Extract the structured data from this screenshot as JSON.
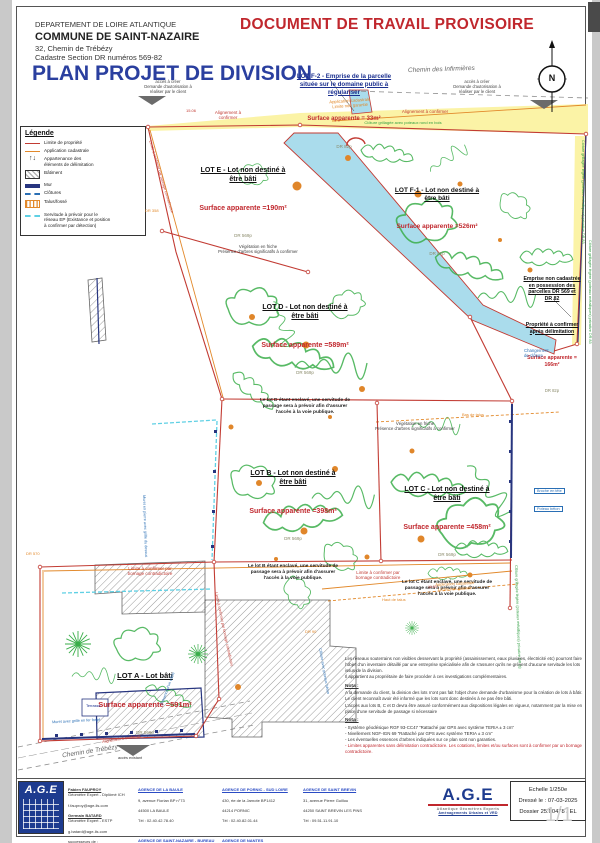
{
  "colors": {
    "title_blue": "#2a3f9f",
    "warning_red": "#c0272d",
    "boundary_red": "#c23b33",
    "cadastral_orange": "#e2892b",
    "vegetation_green": "#3aae4a",
    "water_blue": "#aadcec",
    "road_yellow": "#fbf3a6",
    "wall_blue": "#27357f",
    "servitude_cyan": "#5fd0e4"
  },
  "header": {
    "dept": "DEPARTEMENT DE LOIRE ATLANTIQUE",
    "commune": "COMMUNE DE SAINT-NAZAIRE",
    "address": "32, Chemin de Trébézy",
    "cadastre": "Cadastre Section DR numéros 569-82",
    "title": "PLAN PROJET DE DIVISION",
    "watermark": "DOCUMENT DE TRAVAIL PROVISOIRE"
  },
  "compass": "N",
  "legend": {
    "title": "Légende",
    "items": [
      {
        "label": "Limite de propriété"
      },
      {
        "label": "Application cadastrale"
      },
      {
        "label": "Appartenance des\néléments de délimitation"
      },
      {
        "label": "Bâtiment"
      },
      {
        "label": "Mur"
      },
      {
        "label": "Clôtures"
      },
      {
        "label": "Talus/fossé"
      },
      {
        "label": "Servitude à prévoir pour le\nréseau EP (Existance et position\nà confirmer par détection)"
      }
    ]
  },
  "lots": {
    "f2": {
      "title": "LOT F-2 - Emprise de la parcelle\nsituée sur le domaine public à\nrégulariser",
      "surface": "Surface apparente = 33m²",
      "parcel": "DR 82p"
    },
    "e": {
      "title": "LOT E - Lot non destiné à\nêtre bâti",
      "surface": "Surface apparente =190m²",
      "parcel": "DR 569p"
    },
    "f1": {
      "title": "LOT F-1 - Lot non destiné à\nêtre bâti",
      "surface": "Surface apparente =526m²",
      "parcel": "DR 82p"
    },
    "d": {
      "title": "LOT D - Lot non destiné à\nêtre bâti",
      "surface": "Surface apparente =589m²",
      "parcel": "DR 569p",
      "note": "Le lot D étant enclavé, une servitude de\npassage sera à prévoir afin d'assurer\nl'accès à la voie publique."
    },
    "b": {
      "title": "LOT B - Lot non destiné à\nêtre bâti",
      "surface": "Surface apparente =398m²",
      "parcel": "DR 569p",
      "note": "Le lot B étant enclavé, une servitude de\npassage sera à prévoir afin d'assurer\nl'accès à la voie publique."
    },
    "c": {
      "title": "LOT C - Lot non destiné à\nêtre bâti",
      "surface": "Surface apparente =458m²",
      "parcel": "DR 569p",
      "note": "Le lot C étant enclavé, une servitude de\npassage sera à prévoir afin d'assurer\nl'accès à la voie publique."
    },
    "a": {
      "title": "LOT A - Lot bâti",
      "surface": "Surface apparente =591m²",
      "parcel": "DR 569p"
    },
    "emprise": {
      "title": "Emprise non cadastrée\nen possession des\nparcelles DR 569 et\nDR 82",
      "subtitle": "Propriété à confirmer\naprès délimitation",
      "surface": "Surface apparente =\n166m²",
      "parcel": "DR 82p"
    }
  },
  "ann": {
    "chemin_infirmieres": "Chemin des Infirmières",
    "chemin_trebezy": "Chemin de Trébézy",
    "acces_creer": "accès à créer\nDemande d'autorisation à\nréaliser par le client",
    "acces_existant": "accès existant",
    "alignement": "Alignement à confirmer",
    "alignement2": "Alignement à\nconfirmer",
    "cloture_bois": "Clôture grillagée avec poteaux rond en bois",
    "app_cad": "Application cadastrale\nLimite non garantie",
    "vegetation": "Végétation en friche\nPrésence d'arbres significatifs à confirmer",
    "changement": "Changement\nde clôture",
    "bas_talus": "Bas de talus",
    "haut_talus": "Haut de talus",
    "limite_bornage": "Limite à confirmer par\nbornage contradictoire",
    "limite_bornage_1l": "Limite à confirmer par bornage contradictoire",
    "muret_grille": "Muret avec grille en fer forgé",
    "presence_cable": "Présence d'un câble",
    "terrasse": "Terrasse",
    "broche": "Broche en tête",
    "poteau_beton": "Poteau béton",
    "cloture_legere": "Clôture grillagée légère (poteaux métalliques) privative DR 83",
    "cloture_beton": "Clôture avec poteaux béton",
    "muret_pierre": "Muret en pierre avec grille du dessus",
    "dr358": "DR 358",
    "dr570": "DR 570",
    "dr90": "DR 90"
  },
  "dims": {
    "d1": "15.06",
    "d2": "39.04"
  },
  "notes": {
    "intro": "Les réseaux souterrains non visibles desservant la propriété (assainissement, eaux pluviales, électricité etc) pourront faire l'objet d'un inventaire détaillé par une entreprise spécialisée afin de s'assurer qu'ils ne grèvent d'aucune servitude les lots issus de la division.\nIl appartient au propriétaire de faire procéder à ces investigations complémentaires.",
    "nota1_title": "Nota :",
    "nota1_p1": "A la demande du client, la division des lots  n'ont pas fait l'objet d'une demande d'urbanisme pour la création de lots à bâtir. Le client reconnaît avoir été informé que les lots sont donc destinés à ne pas être bâti.",
    "nota1_p2": "L'accès aux lots B, C et D devra être assuré conformément aux dispositions légales en vigueur, notamment par la mise en place d'une servitude de passage si nécessaire",
    "nota2_title": "Nota :",
    "n2_i1": "- Système géodésique RGF 93-CC47 “Rattaché par GPS avec système TERIA ± 3 cm”",
    "n2_i2": "- Nivellement NGF-IGN 69 “Rattaché par GPS avec système TERIA ± 3 cm”",
    "n2_i3": "- Les éventuelles essences d'arbres indiquées sur ce plan sont non garanties.",
    "n2_i4": "- Limites apparentes sans délimitation contradictoire. Les cotations, limites et/ou surfaces sont à confirmer par un bornage contradictoire."
  },
  "footer": {
    "logo": "A.G.E",
    "logo_sub1": "Atlantique Géomètres Experts",
    "logo_sub2": "Aménagements Urbains et VRD",
    "experts": {
      "e1": "Fabien FAUPROY",
      "e2": "Géomètre Expert - Diplômé ICH",
      "e3": "f.fauproy@age-ils.com",
      "e4": "Germain BATARD",
      "e5": "Géomètre Expert - ESTP",
      "e6": "g.batard@age-ils.com",
      "e7": "successeurs de :",
      "e8": "Etienne PRINCE",
      "e9": "Stéphanie PRIEUR-DELAGE"
    },
    "ag1": {
      "name": "AGENCE DE LA BAULE",
      "a1": "9, avenue Florian BP n°73",
      "a2": "44500 LA BAULE",
      "a3": "Tél : 02.40.42.78.40"
    },
    "ag2": {
      "name": "AGENCE DE SAINT-NAZAIRE - BUREAU VERT",
      "a1": "10 Rue Louis Pasteur",
      "a2": "44600 Saint NAZAIRE",
      "a3": "Tél : 02.40.66.00.04"
    },
    "ag3": {
      "name": "AGENCE DE PORNIC - SUD LOIRE",
      "a1": "430, rte de la Jarnote BP1412",
      "a2": "44214 PORNIC",
      "a3": "Tél : 02.40.82.01.44"
    },
    "ag4": {
      "name": "AGENCE DE NANTES",
      "a1": "20, boulevard Romanet",
      "a2": "44000 NANTES",
      "a3": "Tél : 02.72.65.99.20"
    },
    "ag5": {
      "name": "AGENCE DE SAINT BREVIN",
      "a1": "31, avenue Pierre Guillou",
      "a2": "44250 SAINT BREVIN LES PINS",
      "a3": "Tél : 09.51.11.91.10"
    }
  },
  "titleblock": {
    "echelle": "Echelle 1/250e",
    "dresse": "Dressé le : 07-03-2025",
    "dossier": "Dossier 25.00478 / EL"
  },
  "page_number": "1/1"
}
